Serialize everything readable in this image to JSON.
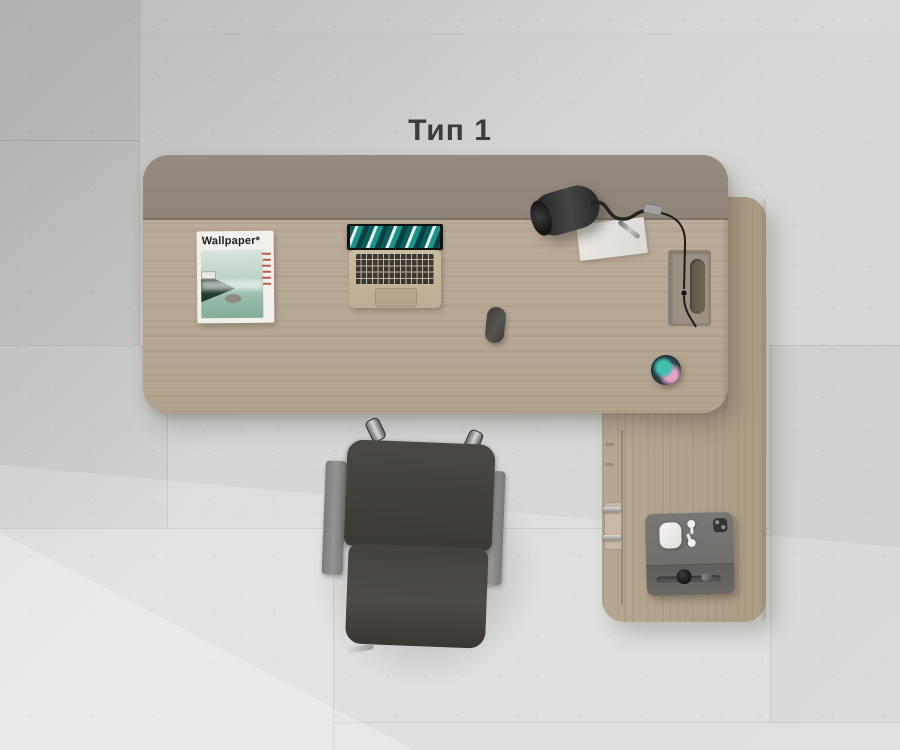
{
  "title": "Тип 1",
  "magazine": {
    "title": "Wallpaper*"
  },
  "scene": {
    "description_objects": [
      "l-shaped-desk",
      "modesty-panel",
      "return-desk",
      "side-cabinet",
      "laptop-open",
      "wallpaper-magazine",
      "desk-lamp",
      "paper-sheet",
      "pen",
      "cable-grommet",
      "computer-mouse",
      "smart-speaker",
      "office-chair",
      "tablet-with-earbuds",
      "concrete-tile-floor"
    ],
    "palette": {
      "floor": "#d5d6d4",
      "desk_wood": "#b8aa93",
      "return_wood": "#b2a38b",
      "modesty_panel": "#8f8679",
      "chair_leather": "#42403c",
      "chair_armrest": "#8c8a88",
      "lamp": "#2a2a2a",
      "laptop_body": "#c4b69a",
      "screen_teal": "#16948d",
      "speaker_teal": "#3fbfae",
      "speaker_pink": "#e8a2c6",
      "title_text": "#3c3c3c"
    }
  }
}
